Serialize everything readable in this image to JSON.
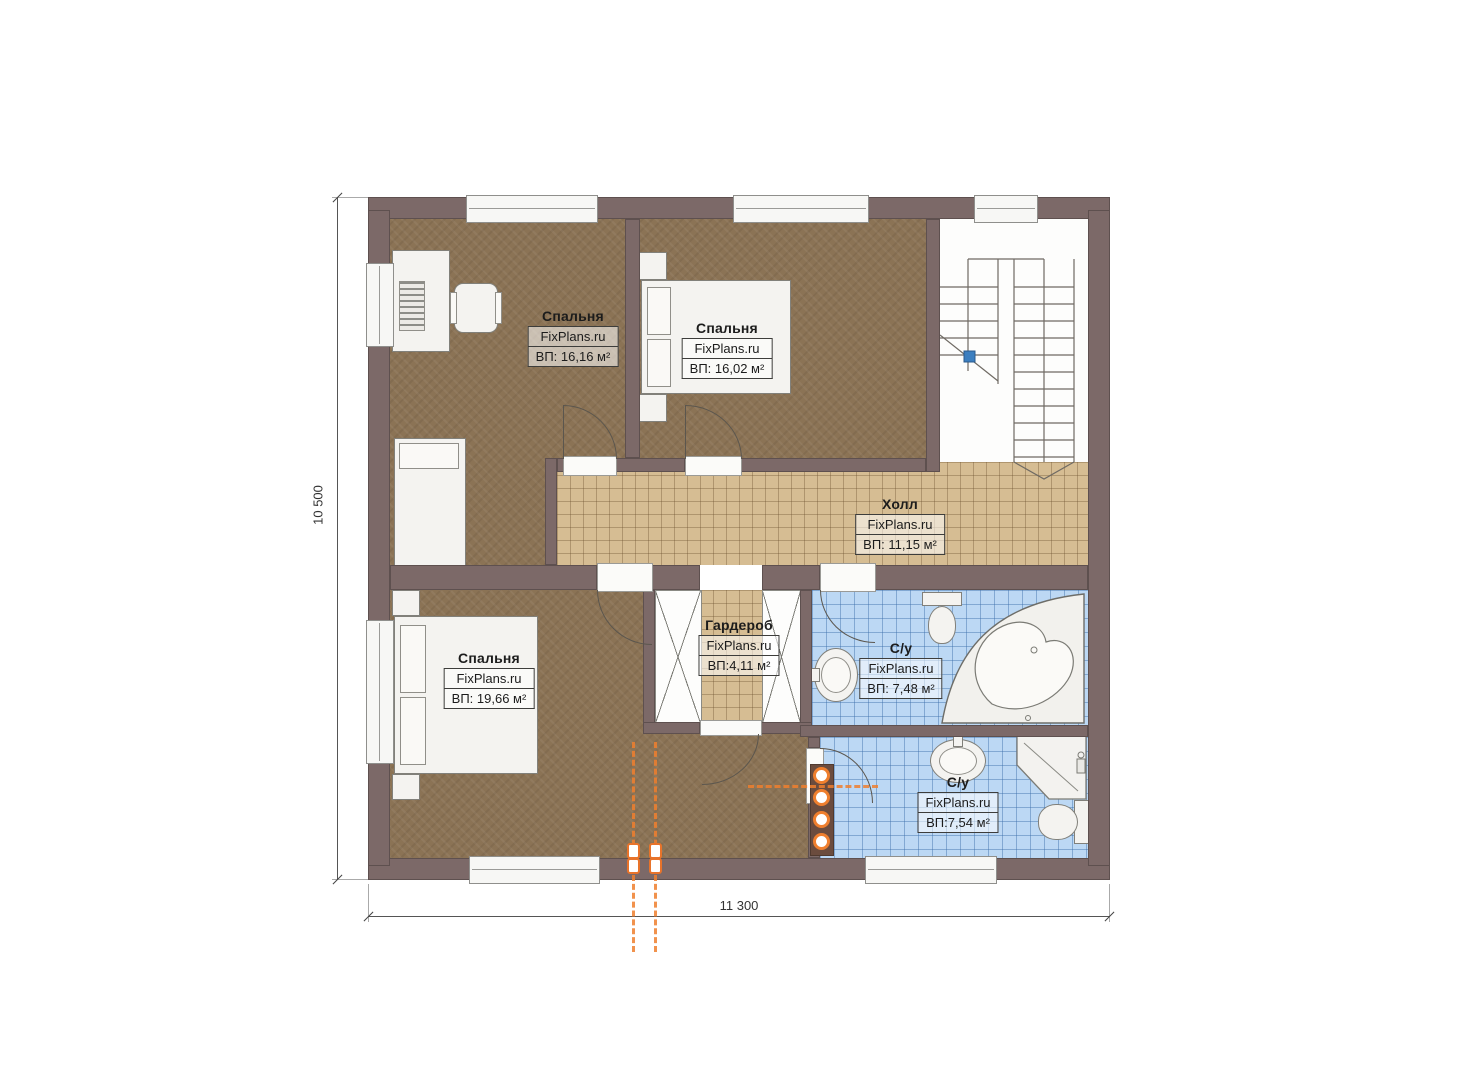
{
  "watermark": "FixPlans.ru",
  "dimensions": {
    "width_label": "11 300",
    "height_label": "10 500"
  },
  "rooms": {
    "bedroom1": {
      "name": "Спальня",
      "area": "ВП: 16,16 м²"
    },
    "bedroom2": {
      "name": "Спальня",
      "area": "ВП: 16,02 м²"
    },
    "bedroom3": {
      "name": "Спальня",
      "area": "ВП: 19,66 м²"
    },
    "hall": {
      "name": "Холл",
      "area": "ВП: 11,15 м²"
    },
    "wardrobe": {
      "name": "Гардероб",
      "area": "ВП:4,11 м²"
    },
    "bath1": {
      "name": "С/у",
      "area": "ВП: 7,48 м²"
    },
    "bath2": {
      "name": "С/у",
      "area": "ВП:7,54 м²"
    }
  },
  "colors": {
    "wall": "#7c6968",
    "bedroom_floor": "#8b7355",
    "hall_tile": "#d6bd93",
    "bath_tile": "#bcd8f4",
    "service_orange": "#ef7f2e",
    "stair_marker": "#3c7fc0"
  }
}
